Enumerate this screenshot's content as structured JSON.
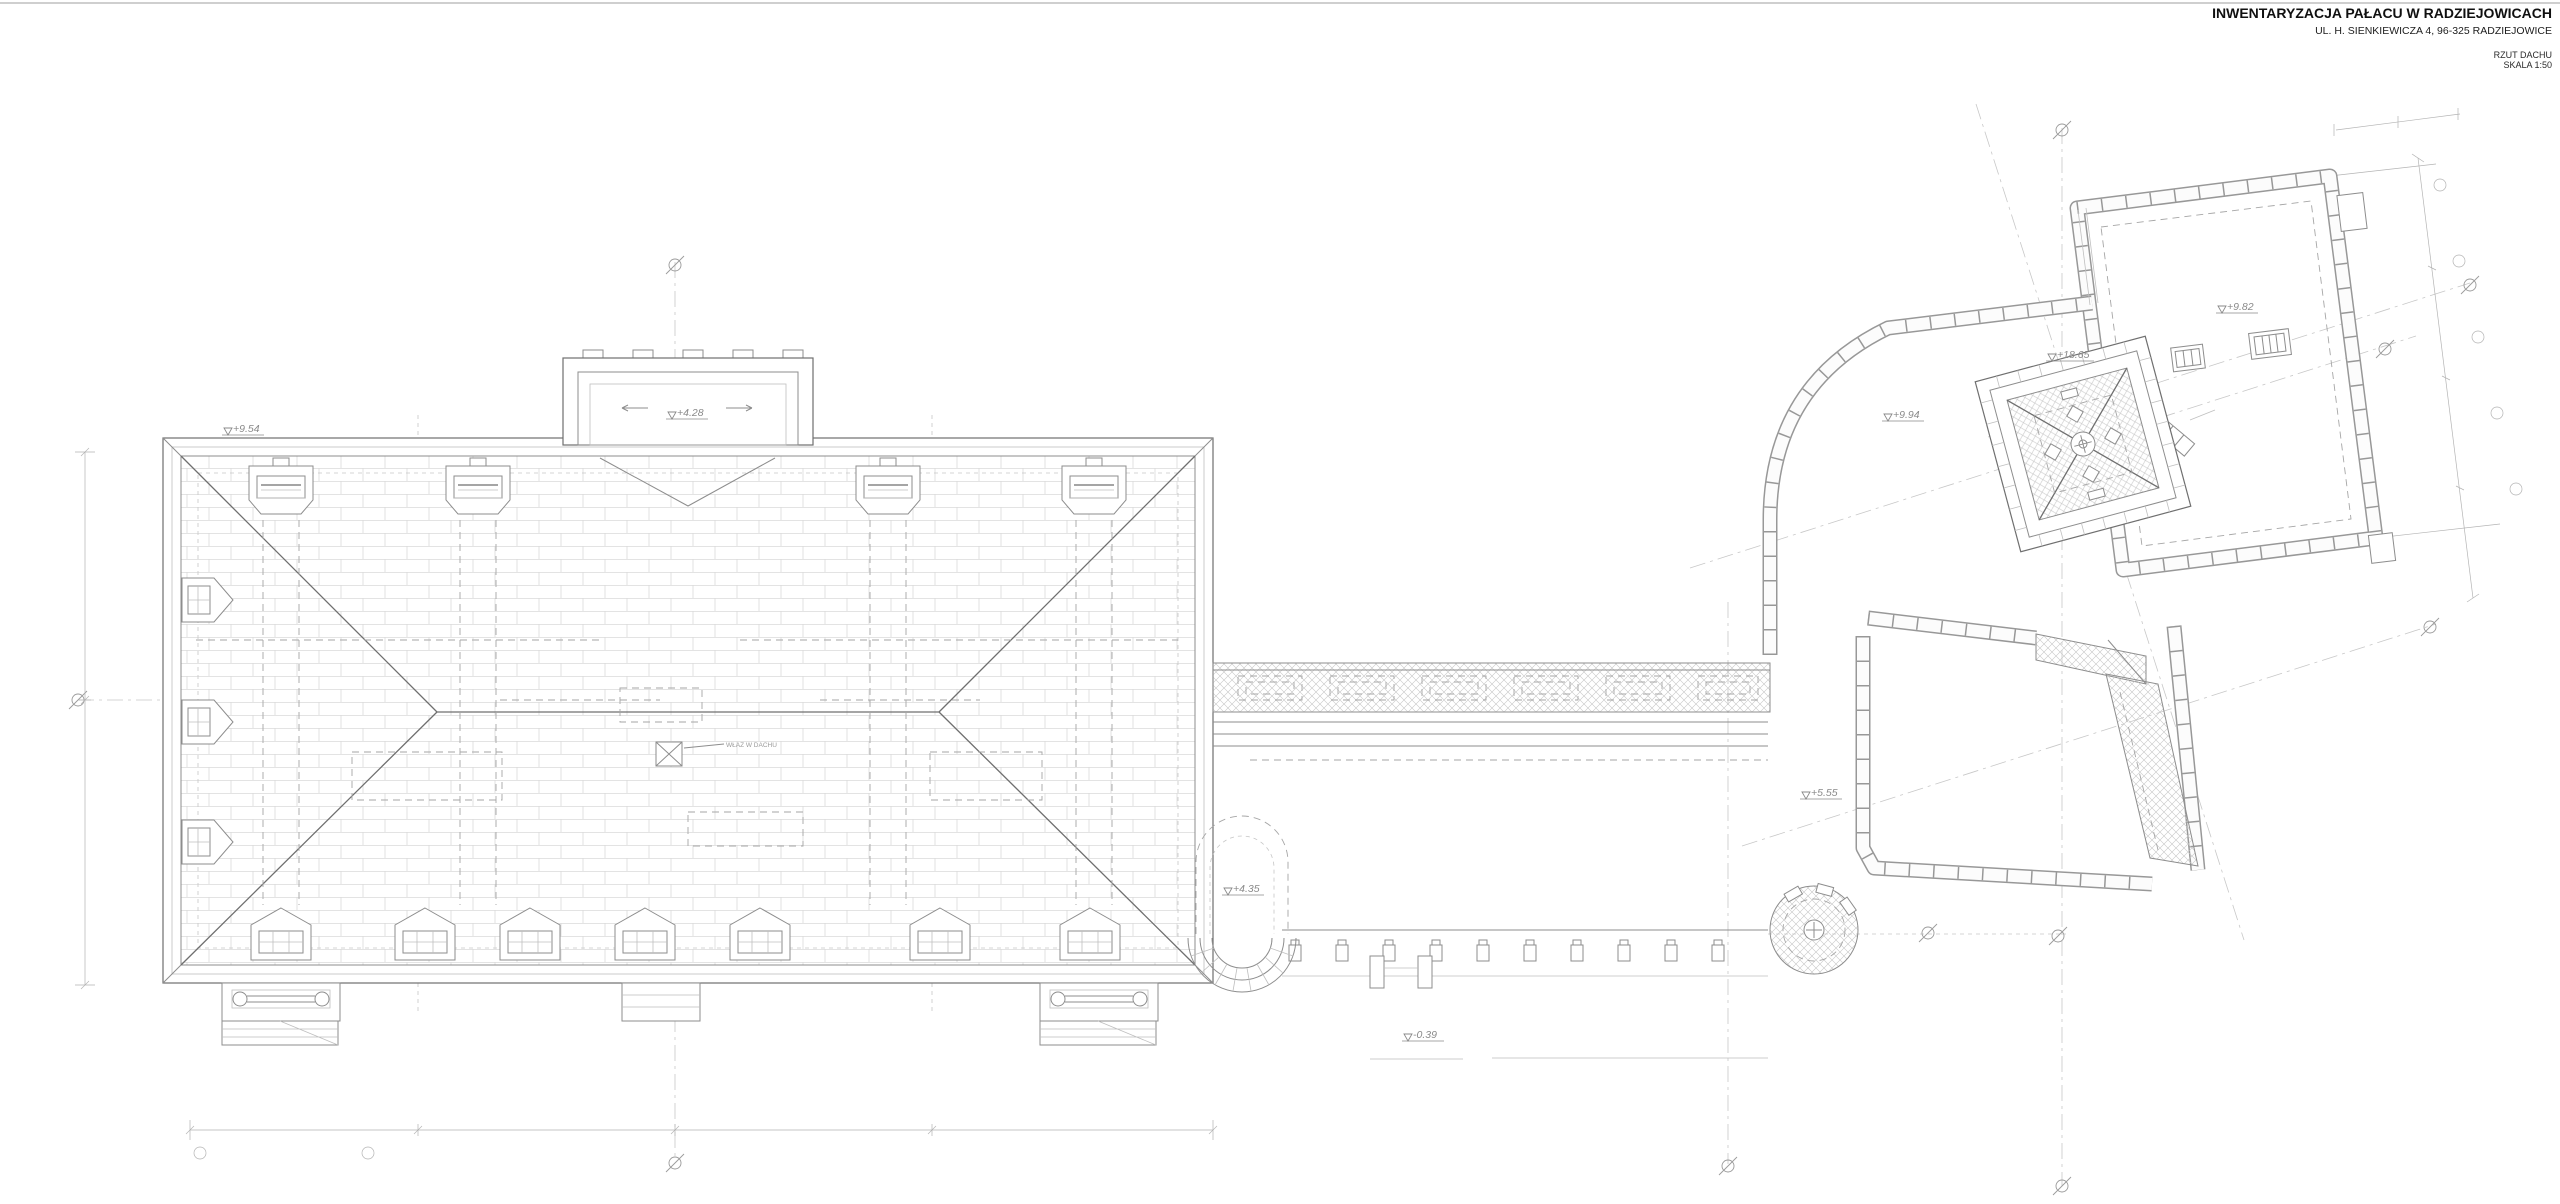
{
  "page": {
    "background": "#ffffff"
  },
  "title_block": {
    "title": "INWENTARYZACJA PAŁACU W RADZIEJOWICACH",
    "address": "UL. H. SIENKIEWICZA 4, 96-325 RADZIEJOWICE",
    "drawing_name": "RZUT DACHU",
    "scale": "SKALA 1:50"
  },
  "levels": {
    "main_roof_eave": "+9.54",
    "avant_corps_roof": "+4.28",
    "apse_roof": "+4.35",
    "terrace": "-0.39",
    "link_building_roof": "+9.94",
    "courtyard_roof": "+5.55",
    "tower_roof": "+18.65",
    "ne_wing_roof": "+9.82"
  },
  "annotations": {
    "roof_hatch": "WŁAZ W DACHU"
  },
  "colors": {
    "line_strong": "#6f6f6f",
    "line": "#8d8d8d",
    "line_light": "#bfbfbf",
    "hatch": "#c6c6c6",
    "text": "#101010"
  }
}
